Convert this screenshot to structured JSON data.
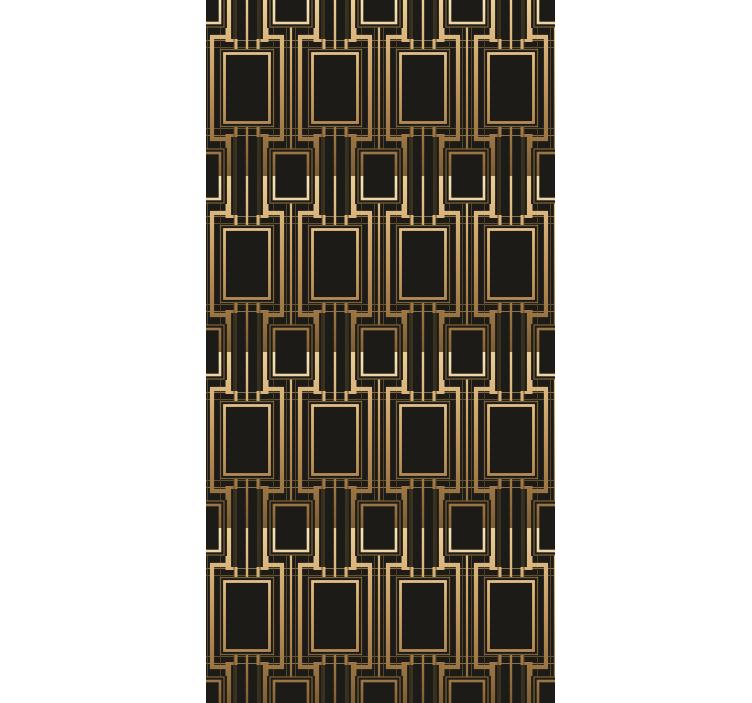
{
  "canvas": {
    "width": 752,
    "height": 703,
    "background": "#ffffff"
  },
  "panel": {
    "left": 206,
    "top": 0,
    "width": 349,
    "height": 703,
    "background": "#1d1b18"
  },
  "pattern": {
    "name": "art-deco-gatsby-lattice",
    "tile": {
      "width": 88,
      "height": 176,
      "offset_x": -3,
      "offset_y": 0
    },
    "colors": {
      "background": "#1d1b18",
      "frame_gradient": [
        "#f8e6b8",
        "#d6ab6e",
        "#8a6435"
      ],
      "chain_gradient": [
        "#eccf96",
        "#c1945a",
        "#7d5e32"
      ],
      "line_mid": "#8a7045",
      "line_dark": "#63502c",
      "line_faint": "#53422a",
      "outer_frame": "#7d6234"
    },
    "geometry": {
      "large_rect": {
        "cx": 44,
        "cy": 88,
        "outer_w": 53,
        "outer_h": 77,
        "inner_w": 45,
        "inner_h": 69,
        "outer_stroke": 1.2,
        "inner_stroke": 2.8
      },
      "small_square": {
        "outer_w": 42,
        "outer_h": 54,
        "inner_w": 34,
        "inner_h": 46,
        "outer_stroke": 1.2,
        "inner_stroke": 2.6
      },
      "chain": {
        "stem_dx": 9,
        "side_dx": 26,
        "elbow_dy": 37,
        "stroke": 4.2
      },
      "small_stem": {
        "center_stroke": 2.2,
        "thin_dx": 4.5,
        "thin_stroke": 0.8,
        "side_rail_dx": 31,
        "side_rail_stroke": 0.9
      },
      "large_stem": {
        "center_stroke": 2.4,
        "thin_dx": 11,
        "thin_stroke": 0.85
      },
      "staircase": {
        "stroke": 3.0,
        "x_in": 33,
        "x_mid": 24,
        "y_rect_bot": 126.5,
        "y_rail_bot": 135.5,
        "y_end_bot": 148,
        "y_rect_top": 49.5,
        "y_rail_top": 40.5,
        "y_end_top": 28
      },
      "h_rails": [
        40.5,
        47.5,
        128.5,
        135.5
      ],
      "v_rails": [
        17.5,
        70.5
      ]
    }
  }
}
